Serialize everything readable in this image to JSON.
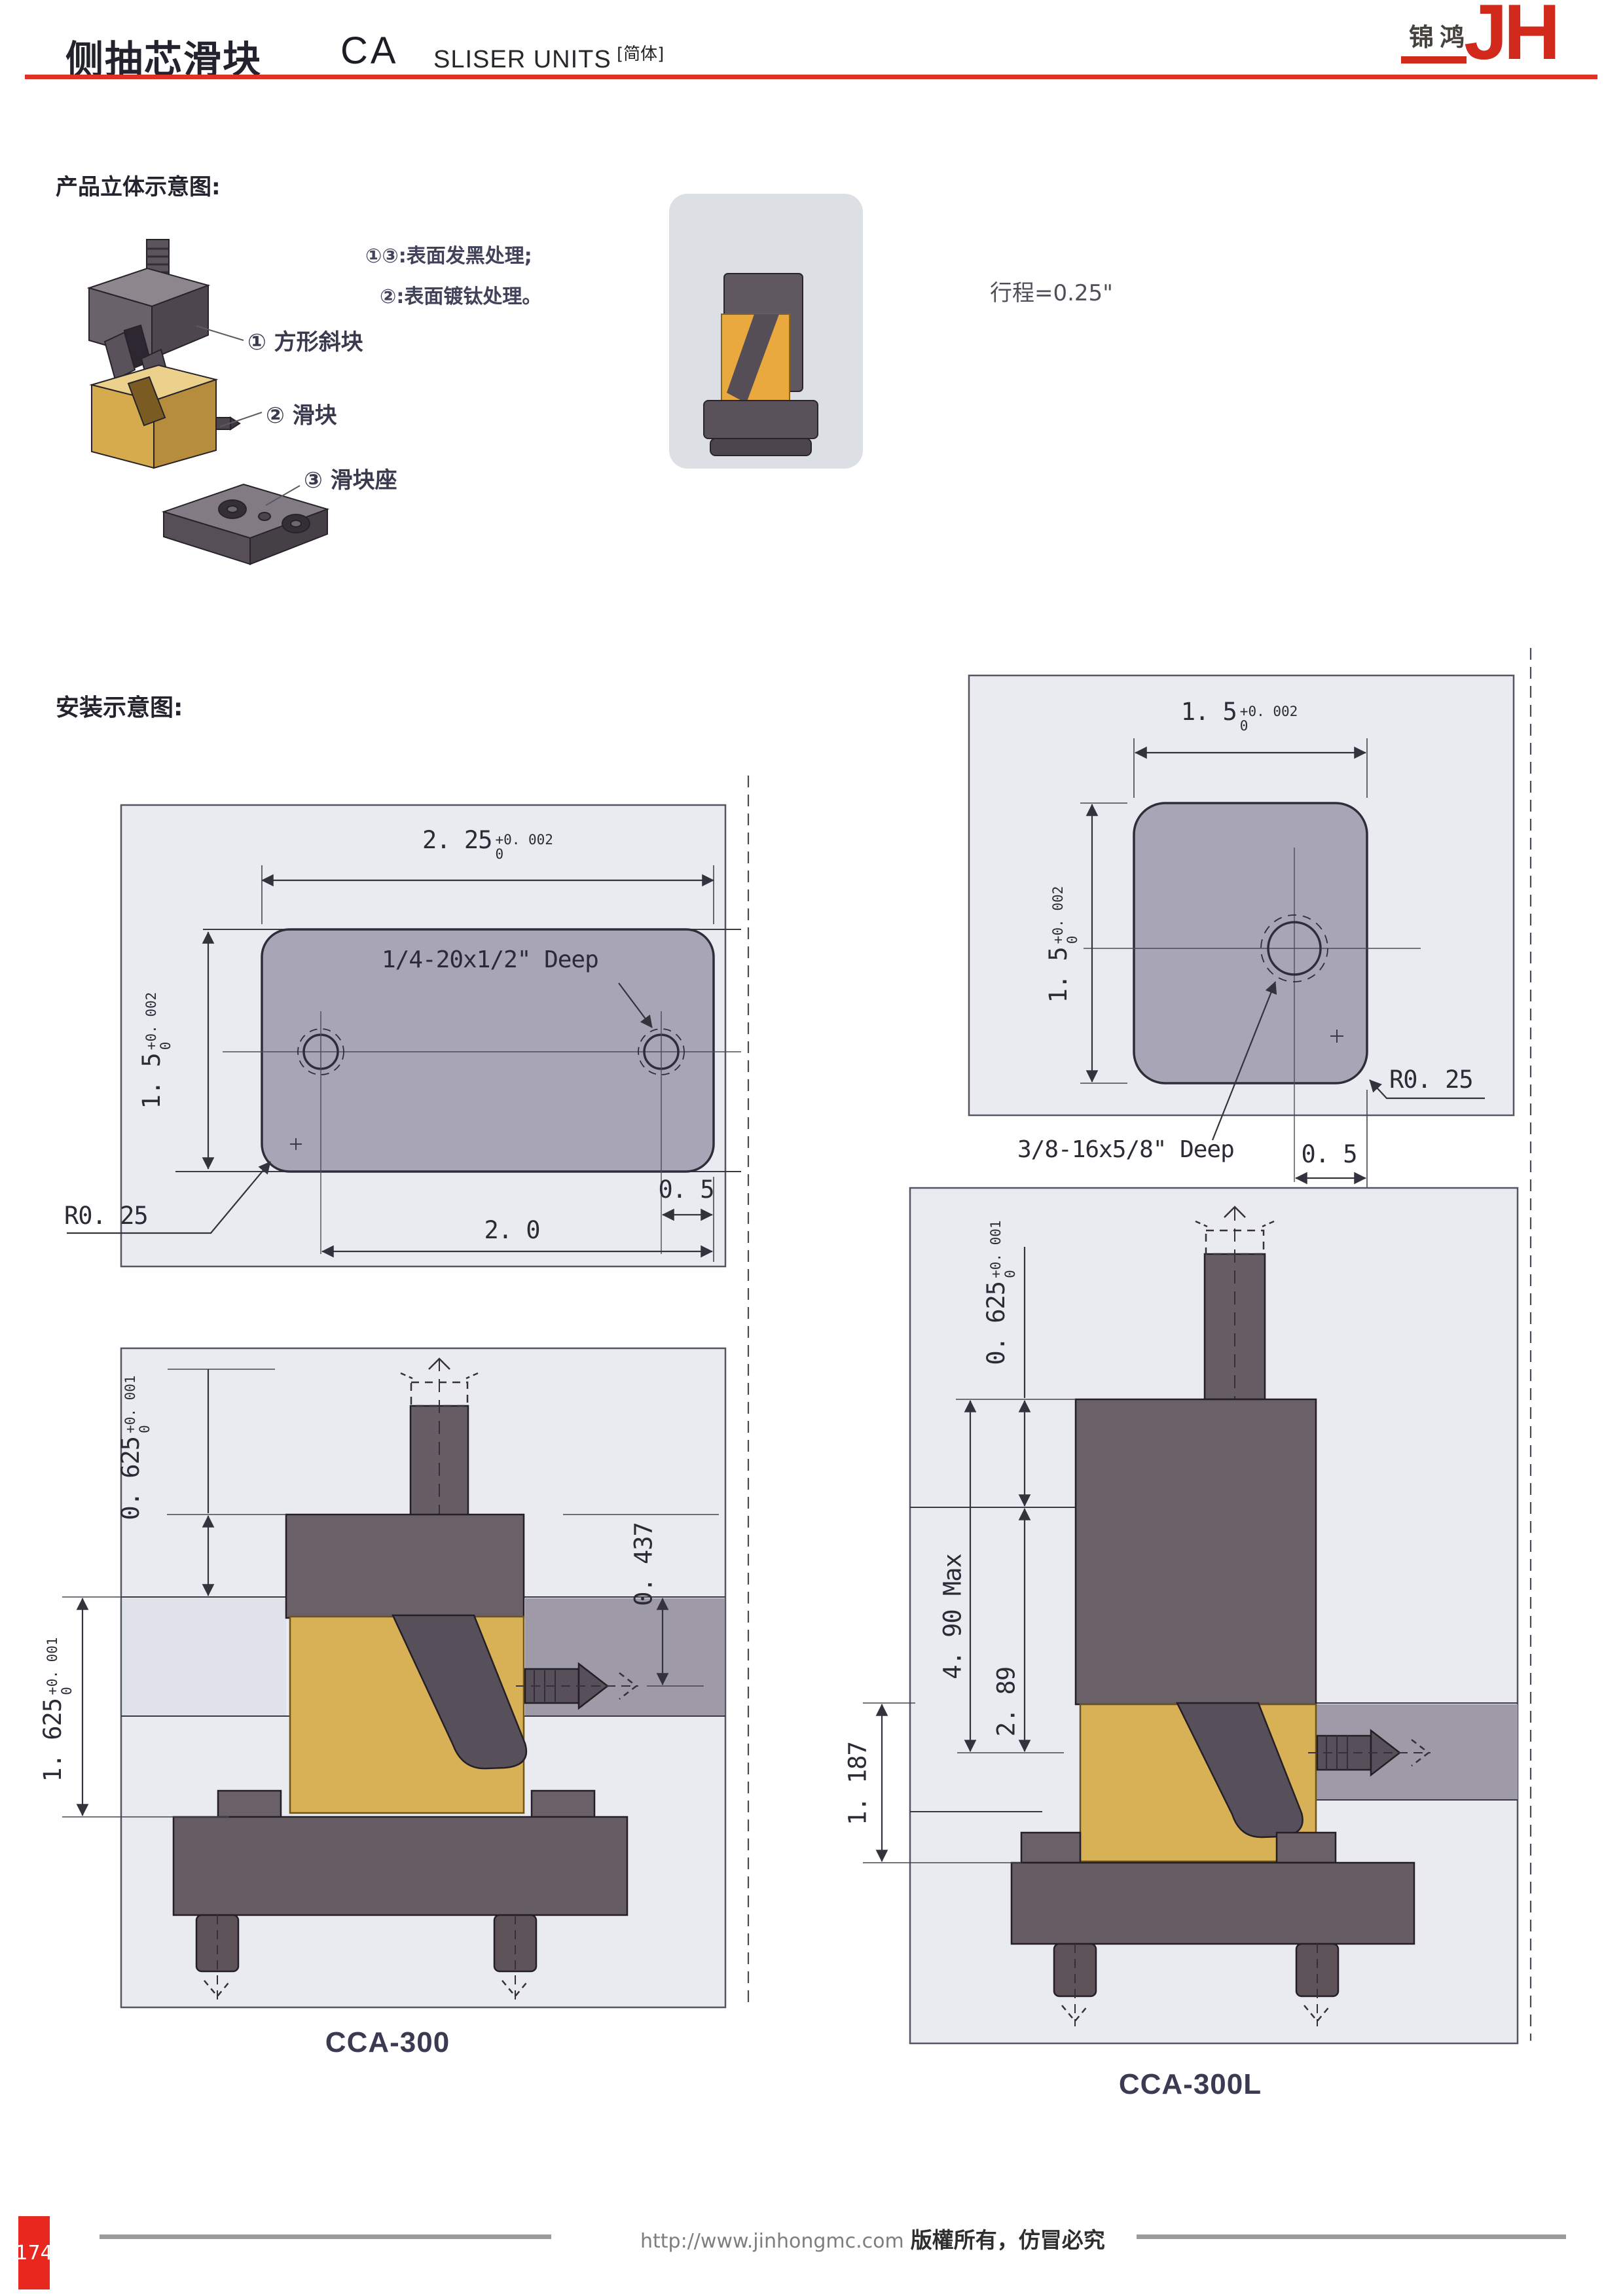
{
  "header": {
    "title_cn": "侧抽芯滑块",
    "title_code": "CA",
    "title_en": "SLISER UNITS",
    "lang_tag": "[简体]",
    "logo_cn": "锦鸿",
    "logo_jh": "JH"
  },
  "product": {
    "heading": "产品立体示意图:",
    "parts": [
      {
        "num_label": "① 方形斜块"
      },
      {
        "num_label": "② 滑块"
      },
      {
        "num_label": "③ 滑块座"
      }
    ],
    "notes": [
      "①③:表面发黑处理;",
      "②:表面镀钛处理。"
    ],
    "stroke_note": "行程=0.25\""
  },
  "install": {
    "heading": "安装示意图:"
  },
  "drawings": {
    "plan_a": {
      "width": {
        "v": "2. 25",
        "t": "+0. 002",
        "b": "0"
      },
      "height": {
        "v": "1. 5",
        "t": "+0. 002",
        "b": "0"
      },
      "thread": "1/4-20x1/2\" Deep",
      "radius": "R0. 25",
      "edge": "0. 5",
      "spacing": "2. 0"
    },
    "plan_b": {
      "width": {
        "v": "1. 5",
        "t": "+0. 002",
        "b": "0"
      },
      "height": {
        "v": "1. 5",
        "t": "+0. 002",
        "b": "0"
      },
      "thread": "3/8-16x5/8\" Deep",
      "radius": "R0. 25",
      "edge": "0. 5"
    },
    "side_a": {
      "top": {
        "v": "0. 625",
        "t": "+0. 001",
        "b": "0"
      },
      "drop": "0. 437",
      "height": {
        "v": "1. 625",
        "t": "+0. 001",
        "b": "0"
      },
      "model": "CCA-300"
    },
    "side_b": {
      "top": {
        "v": "0. 625",
        "t": "+0. 001",
        "b": "0"
      },
      "max": "4. 90 Max",
      "mid": "2. 89",
      "height": "1. 187",
      "model": "CCA-300L"
    }
  },
  "footer": {
    "page": "174",
    "url": "http://www.jinhongmc.com",
    "rights": "版權所有，仿冒必究"
  }
}
